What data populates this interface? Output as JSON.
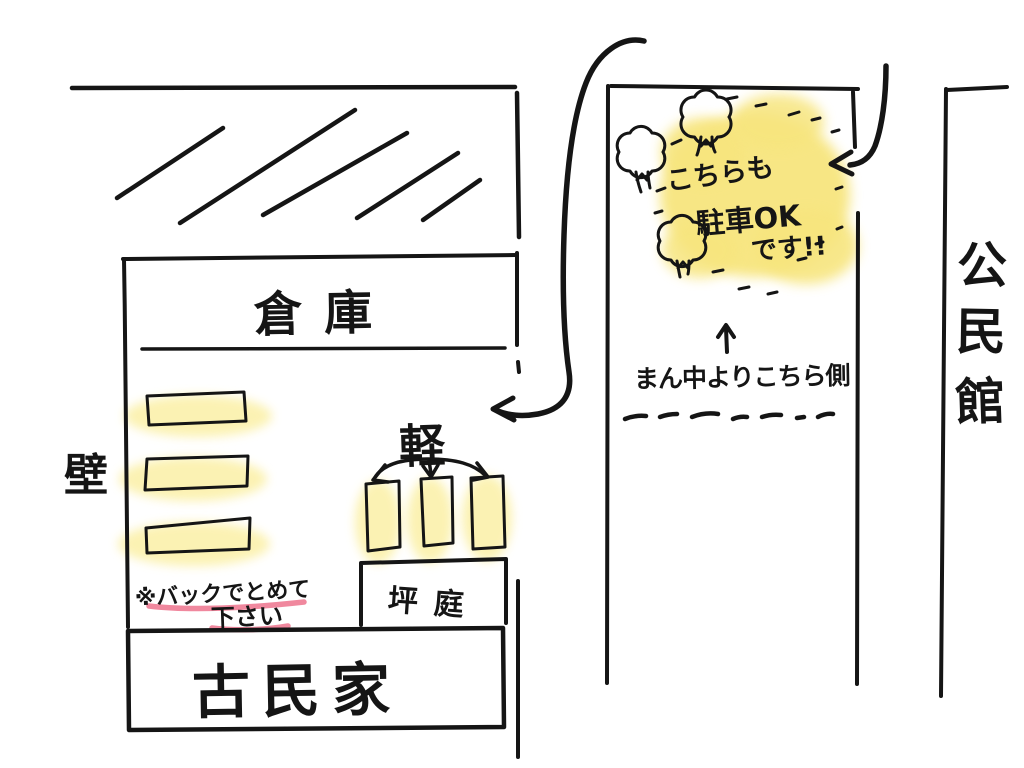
{
  "title": "hand-drawn parking guide sketch",
  "colors": {
    "background": "#ffffff",
    "ink": "#151515",
    "highlight": "#f7e57e",
    "highlight_halo": "#fbf0a6",
    "underline_red": "#ee7b93"
  },
  "left_block": {
    "warehouse_label": "倉庫",
    "wall_label": "壁",
    "kei_label": "軽",
    "courtyard_label": "坪庭",
    "house_label": "古民家",
    "reverse_note_line1": "※バックでとめて",
    "reverse_note_line2": "下さい"
  },
  "middle_block": {
    "ok_note_line1": "こちらも",
    "ok_note_line2": "駐車OK",
    "ok_note_line3": "です!!",
    "center_note": "まん中よりこちら側"
  },
  "right_block": {
    "community_center_label": "公民館",
    "community_center_chars": [
      "公",
      "民",
      "館"
    ]
  }
}
